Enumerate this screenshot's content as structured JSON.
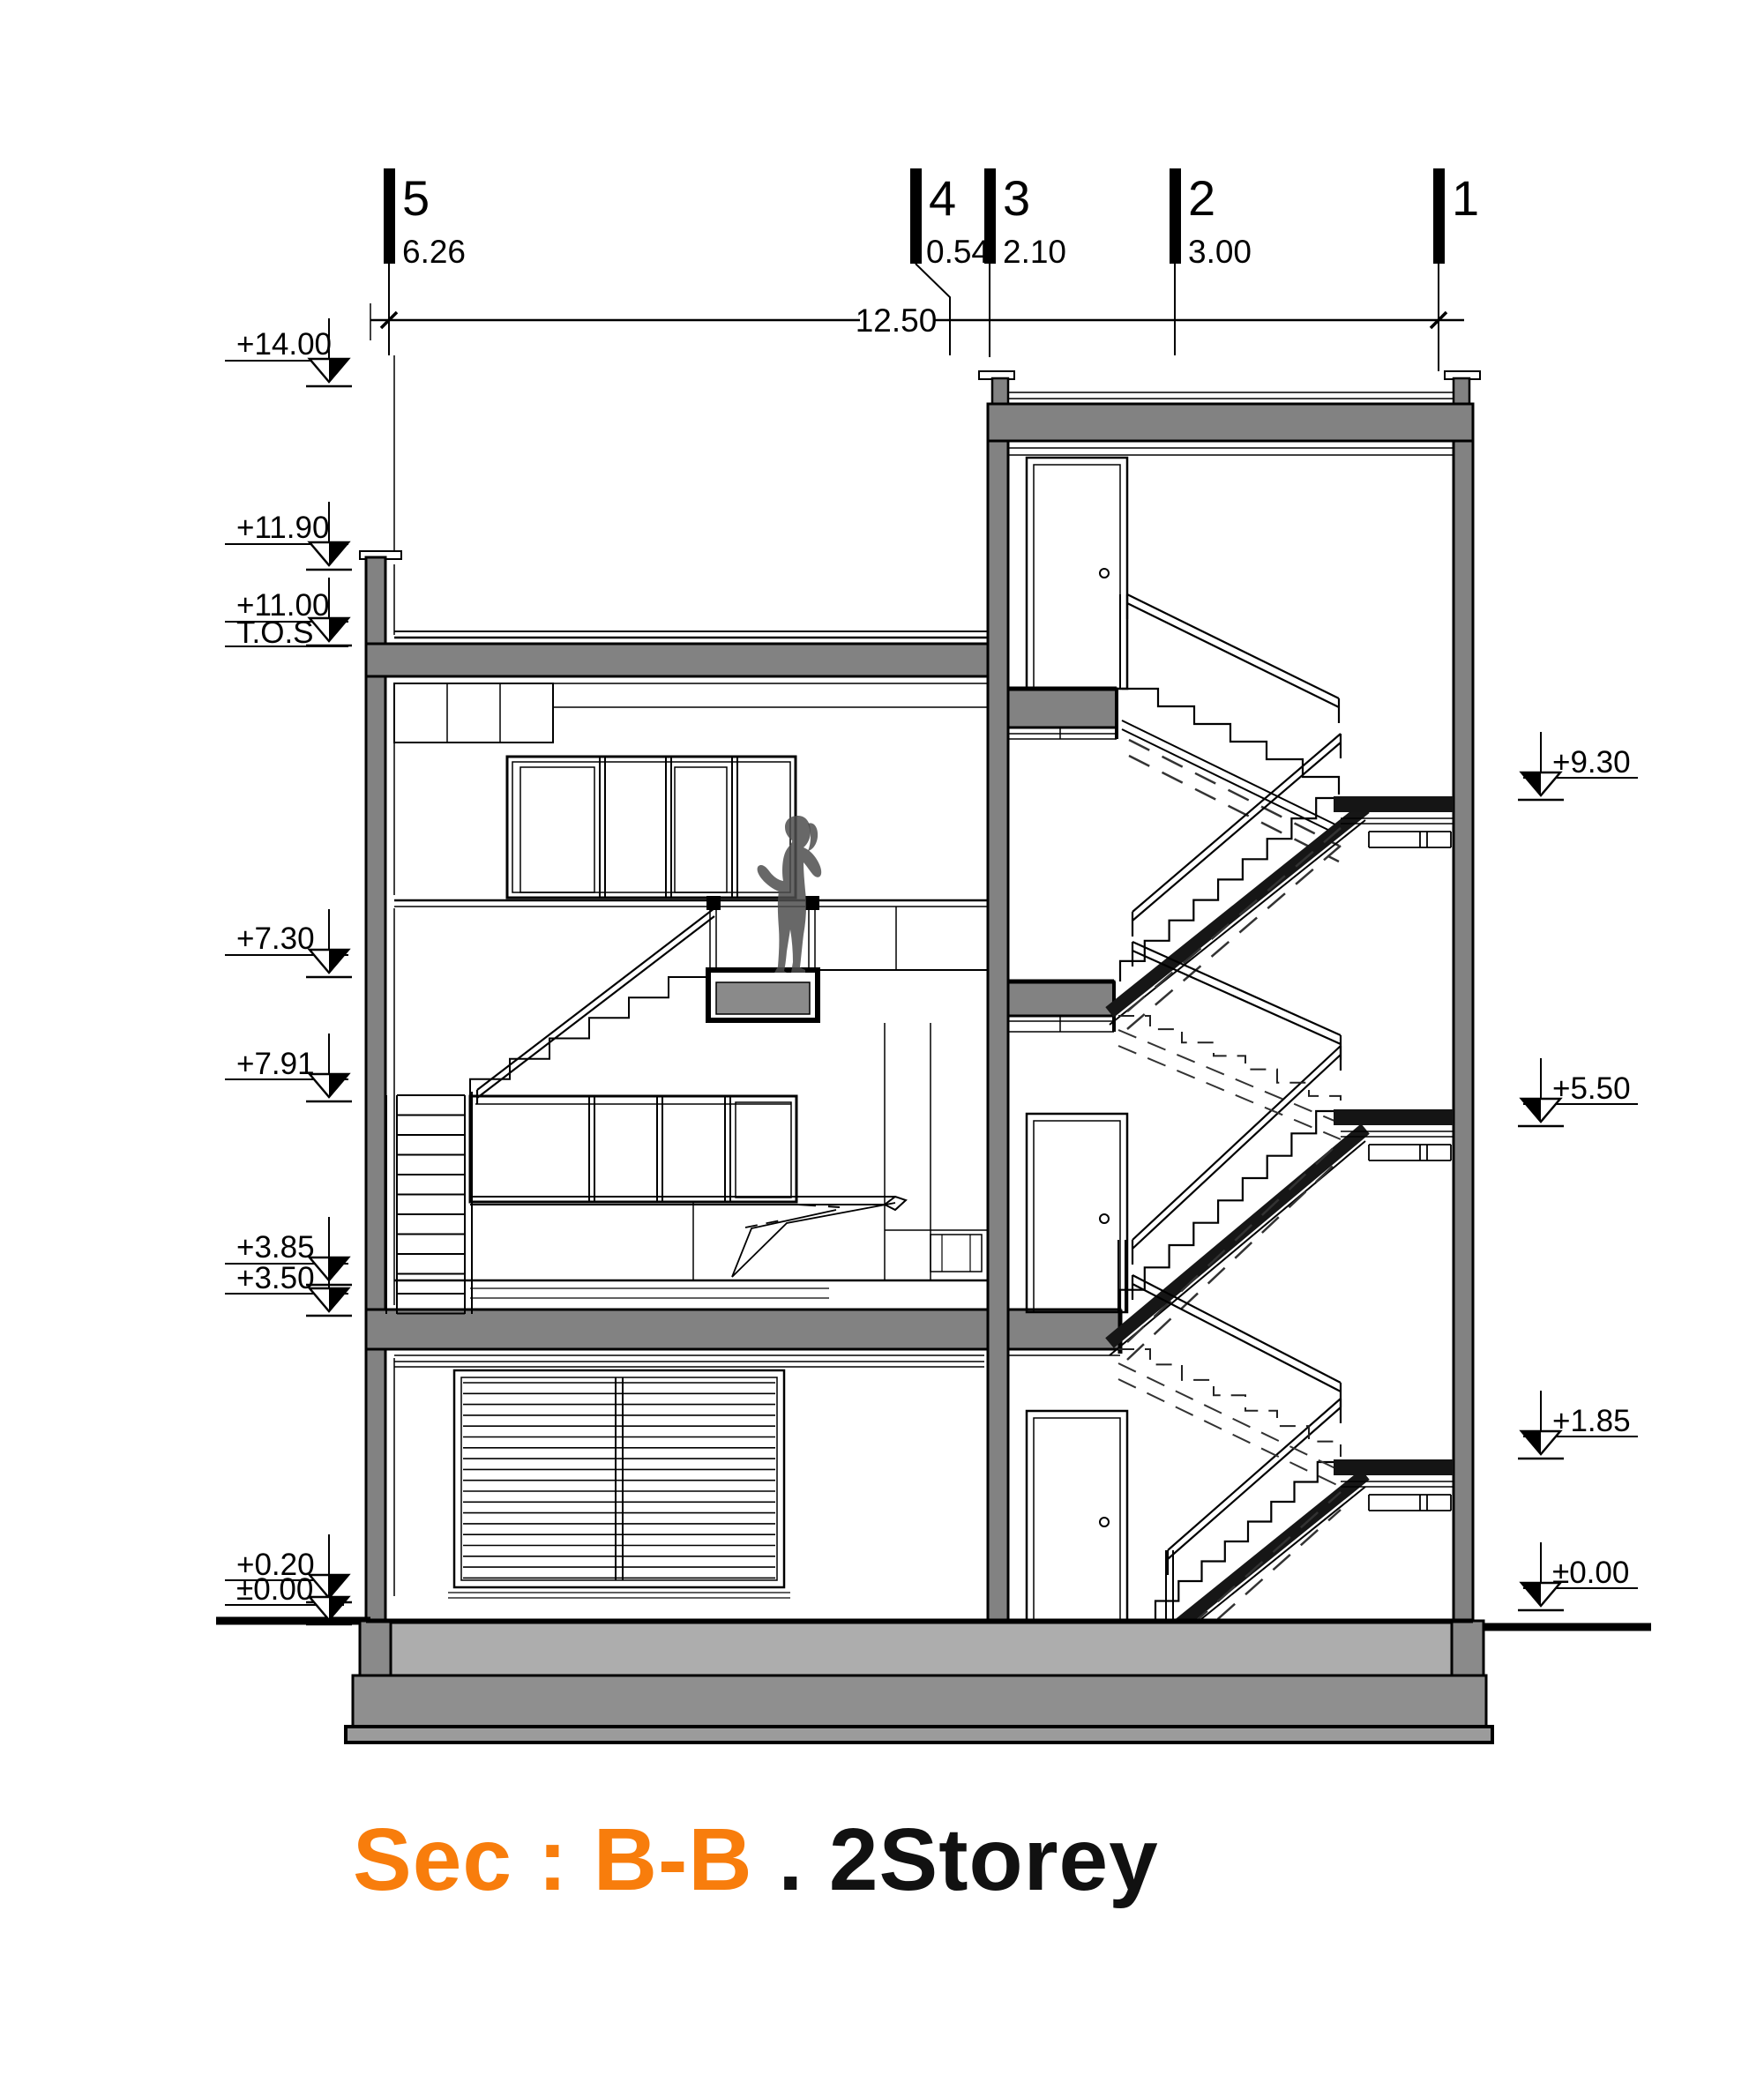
{
  "title": {
    "section_label": "Sec : B-B",
    "storey_label": " . 2Storey"
  },
  "grid": {
    "numbers": [
      "5",
      "4",
      "3",
      "2",
      "1"
    ],
    "spacings": [
      "6.26",
      "0.54",
      "2.10",
      "3.00"
    ],
    "overall": "12.50"
  },
  "levels": {
    "left": [
      "+14.00",
      "+11.90",
      "+11.00",
      "+7.30",
      "+7.91",
      "+3.85",
      "+3.50",
      "+0.20",
      "±0.00"
    ],
    "tos": "T.O.S",
    "right": [
      "+9.30",
      "+5.50",
      "+1.85",
      "±0.00"
    ]
  },
  "colors": {
    "accent_orange": "#F87D0C",
    "wall_gray": "#828282",
    "slab_light": "#ADADAD",
    "footing_gray": "#8F8F8F",
    "ink": "#000000"
  }
}
